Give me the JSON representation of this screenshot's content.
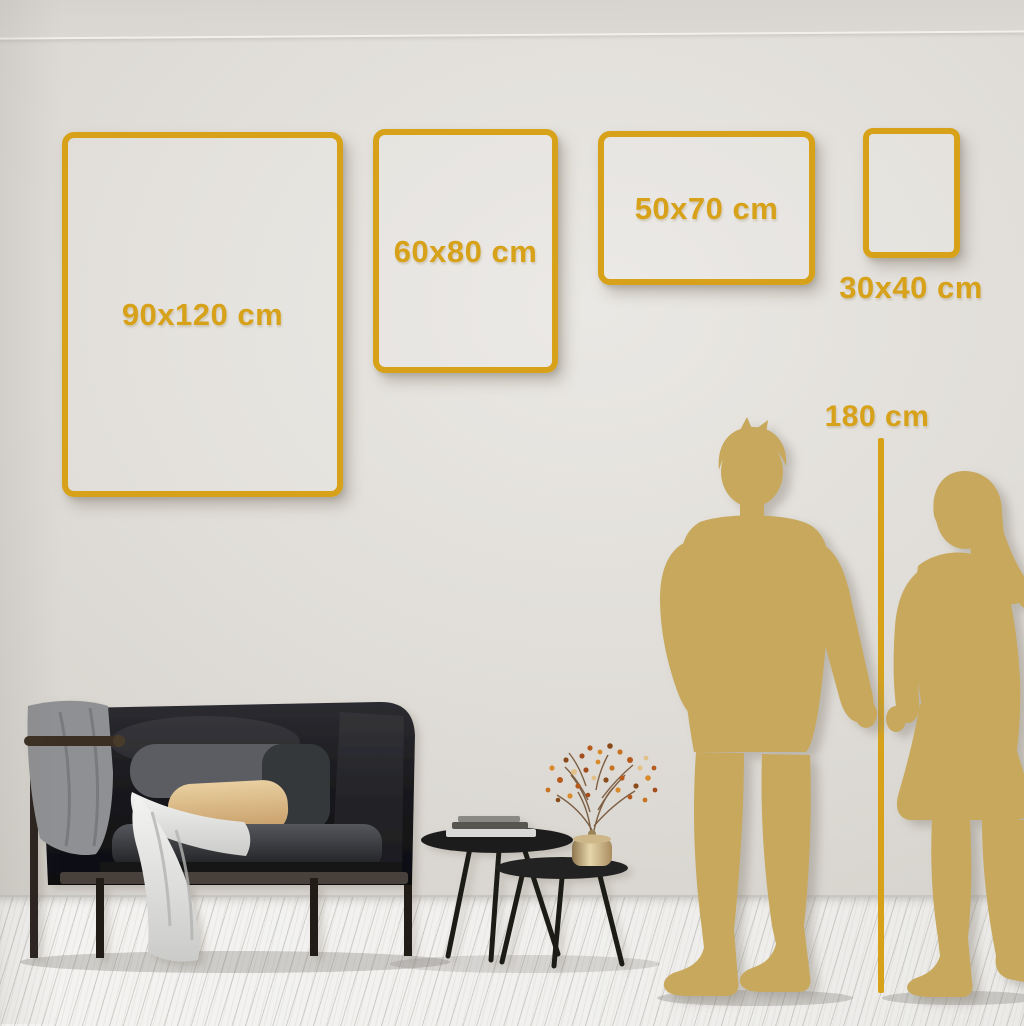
{
  "size_guide": {
    "frames": [
      {
        "name": "frame-90x120",
        "label": "90x120 cm",
        "label_position": "inside"
      },
      {
        "name": "frame-60x80",
        "label": "60x80 cm",
        "label_position": "inside"
      },
      {
        "name": "frame-50x70",
        "label": "50x70 cm",
        "label_position": "inside"
      },
      {
        "name": "frame-30x40",
        "label": "30x40 cm",
        "label_position": "below"
      }
    ],
    "height_marker": {
      "label": "180 cm"
    }
  },
  "colors": {
    "accent_gold": "#D7A219",
    "silhouette_gold": "#C7A85C",
    "wall": "#DDDAD5",
    "floor": "#F1F0EE"
  }
}
